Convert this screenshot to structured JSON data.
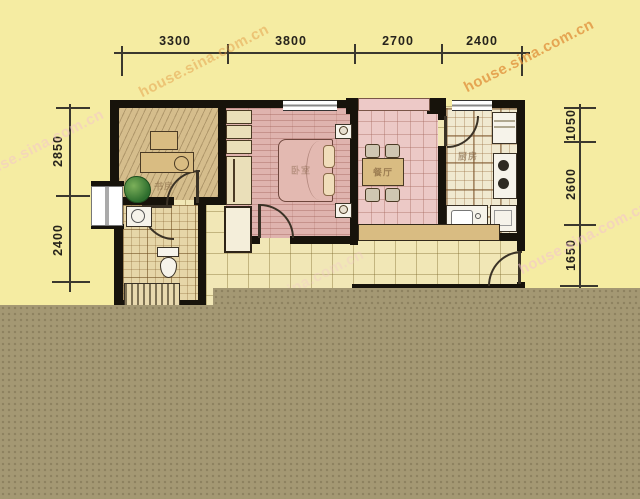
{
  "watermarks": [
    {
      "text": "house.sina.com.cn",
      "color": "#e2943f",
      "opacity": 0.8
    },
    {
      "text": "house.sina.com.cn",
      "color": "#e2943f",
      "opacity": 0.45
    },
    {
      "text": "house.sina.com.cn",
      "color": "#f4c3cf",
      "opacity": 0.5
    },
    {
      "text": "house.sina.com.cn",
      "color": "#f4c3cf",
      "opacity": 0.3
    },
    {
      "text": "house.sina.com.cn",
      "color": "#f4c3cf",
      "opacity": 0.55
    }
  ],
  "dimensions_mm": {
    "top": [
      "3300",
      "3800",
      "2700",
      "2400"
    ],
    "left": [
      "2850",
      "2400"
    ],
    "right": [
      "1050",
      "2600",
      "1650"
    ]
  },
  "room_labels": {
    "study": "书房",
    "bedroom": "卧室",
    "dining": "餐厅",
    "kitchen": "厨房"
  },
  "colors": {
    "background": "#f5eca2",
    "censor_band": "#a49873",
    "wall": "#17130b",
    "bedroom_floor": "#dfb3ae",
    "dining_floor": "#ecc9c6",
    "study_floor": "#d5bd8c",
    "living_tile_floor": "#f1e7b6",
    "kitchen_floor": "#f0e9d0",
    "dimension_text": "#26231c"
  }
}
